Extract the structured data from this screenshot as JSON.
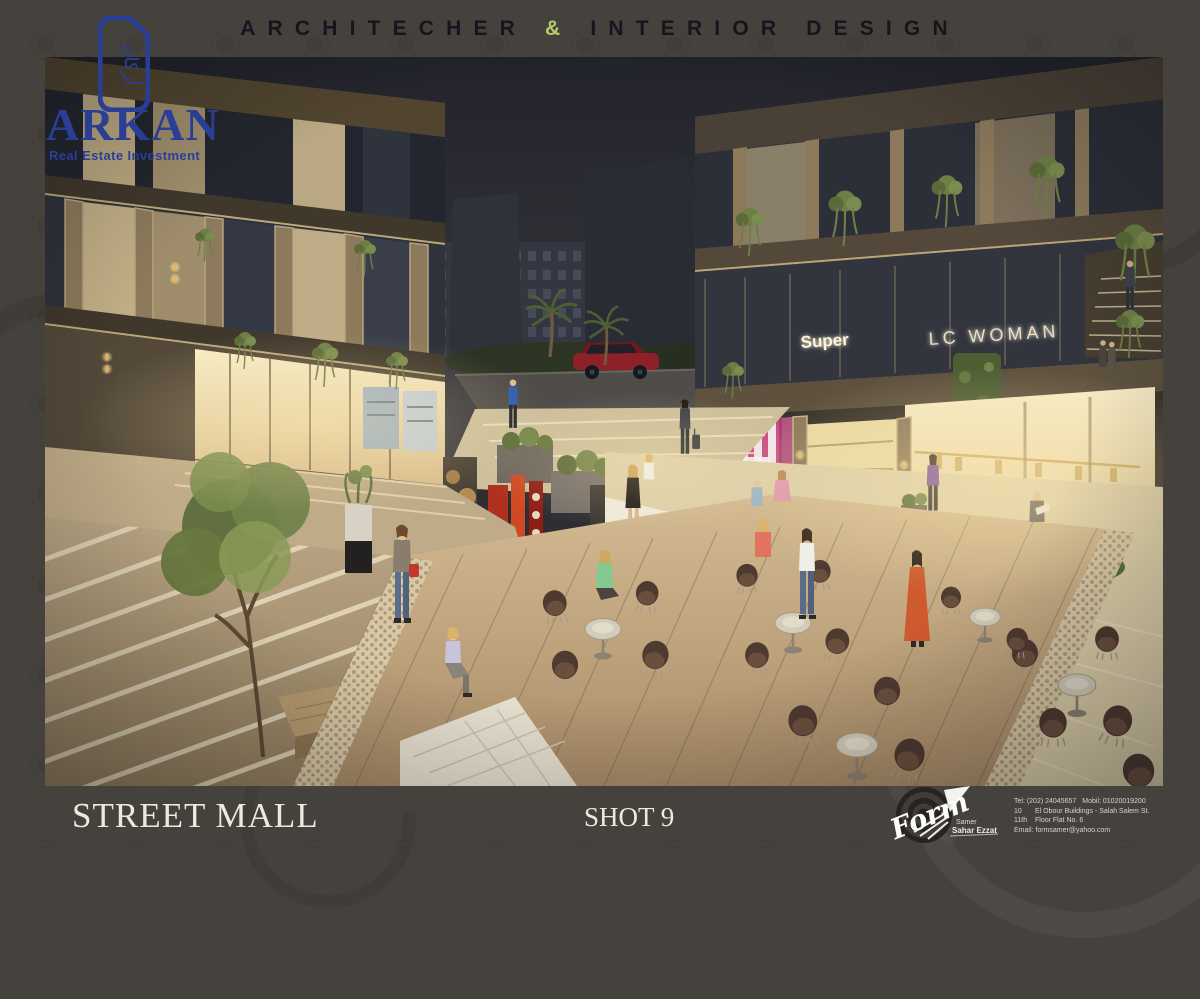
{
  "palette": {
    "background": "#45423e",
    "brand_blue": "#2b3e96",
    "header_text": "#16151d",
    "ampersand_green": "#b6cd6b",
    "footer_text": "#eee9e0"
  },
  "header": {
    "title_part1": "ARCHITECHER",
    "ampersand": "&",
    "title_part2": "INTERIOR DESIGN"
  },
  "logo": {
    "name": "ARKAN",
    "tagline": "Real Estate Investment",
    "arabic": "أركان"
  },
  "scene": {
    "signs": {
      "supermarket": "Super",
      "boutique": "LC WOMAN"
    }
  },
  "footer": {
    "project_title": "STREET MALL",
    "shot": "SHOT 9",
    "studio": {
      "name": "Form",
      "signature_top": "Samer",
      "signature_bottom": "Sahar Ezzat",
      "contact": {
        "tel": "Tel: (202) 24045657",
        "mobile": "Mobil: 01020019200",
        "address_no": "10",
        "address": "El Obour Buildings - Salah Salem St.",
        "floor_no": "11th",
        "floor": "Floor Flat No. 6",
        "email": "Email: formsamer@yahoo.com"
      }
    }
  }
}
